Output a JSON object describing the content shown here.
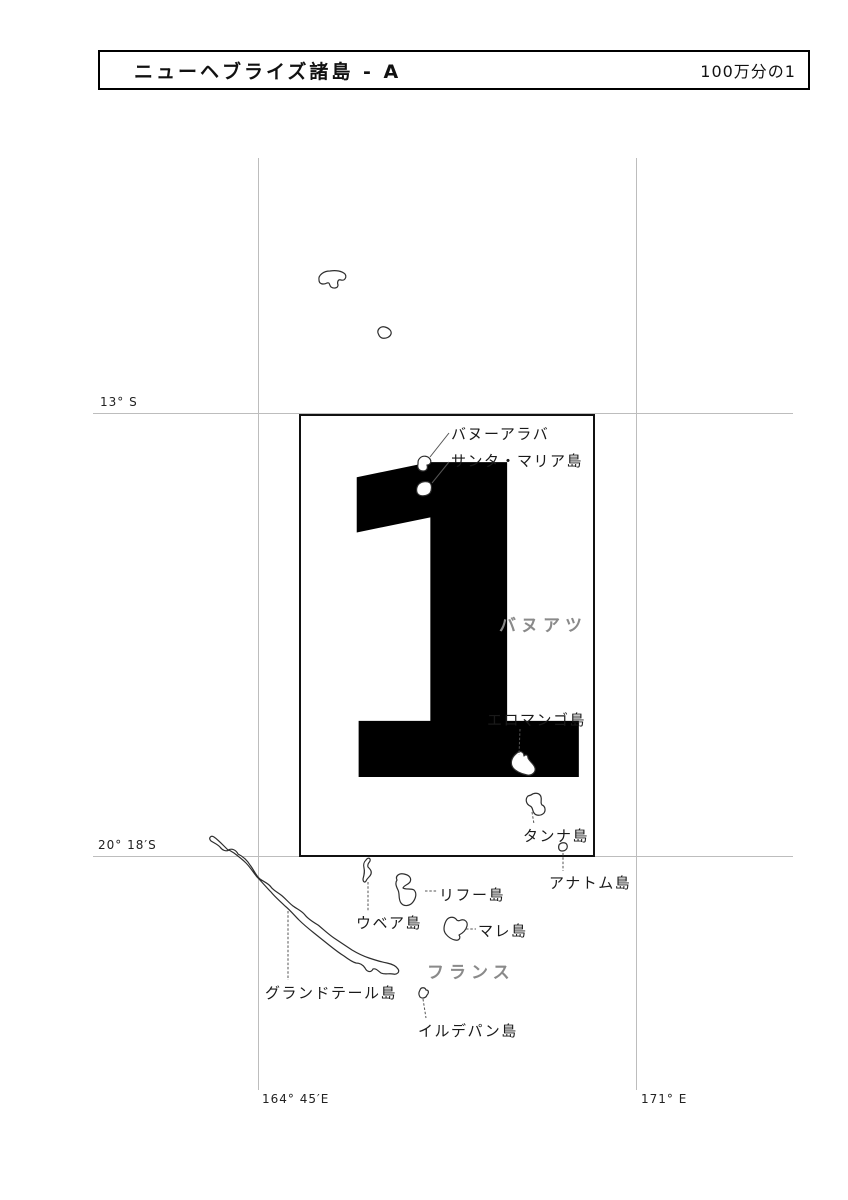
{
  "header": {
    "title": "ニューヘブライズ諸島 - A",
    "scale": "100万分の1"
  },
  "sheet": {
    "number": "1"
  },
  "graticule": {
    "lat_13s": "13° S",
    "lat_20_18s": "20° 18′S",
    "lon_164_45e": "164° 45′E",
    "lon_171e": "171° E"
  },
  "regions": {
    "vanuatu": "バヌアツ",
    "france": "フランス"
  },
  "islands": {
    "vanua_lava": "バヌーアラバ",
    "santa_maria": "サンタ・マリア島",
    "erromango": "エロマンゴ島",
    "tanna": "タンナ島",
    "anatom": "アナトム島",
    "lifou": "リフー島",
    "ouvea": "ウベア島",
    "mare": "マレ島",
    "grande_terre": "グランドテール島",
    "ile_des_pins": "イルデパン島"
  },
  "colors": {
    "background": "#ffffff",
    "ink": "#111111",
    "gridline": "#bdbdbd",
    "region_label": "#8a8a8a",
    "island_outline": "#2e2e2e",
    "leader_line": "#555555"
  }
}
